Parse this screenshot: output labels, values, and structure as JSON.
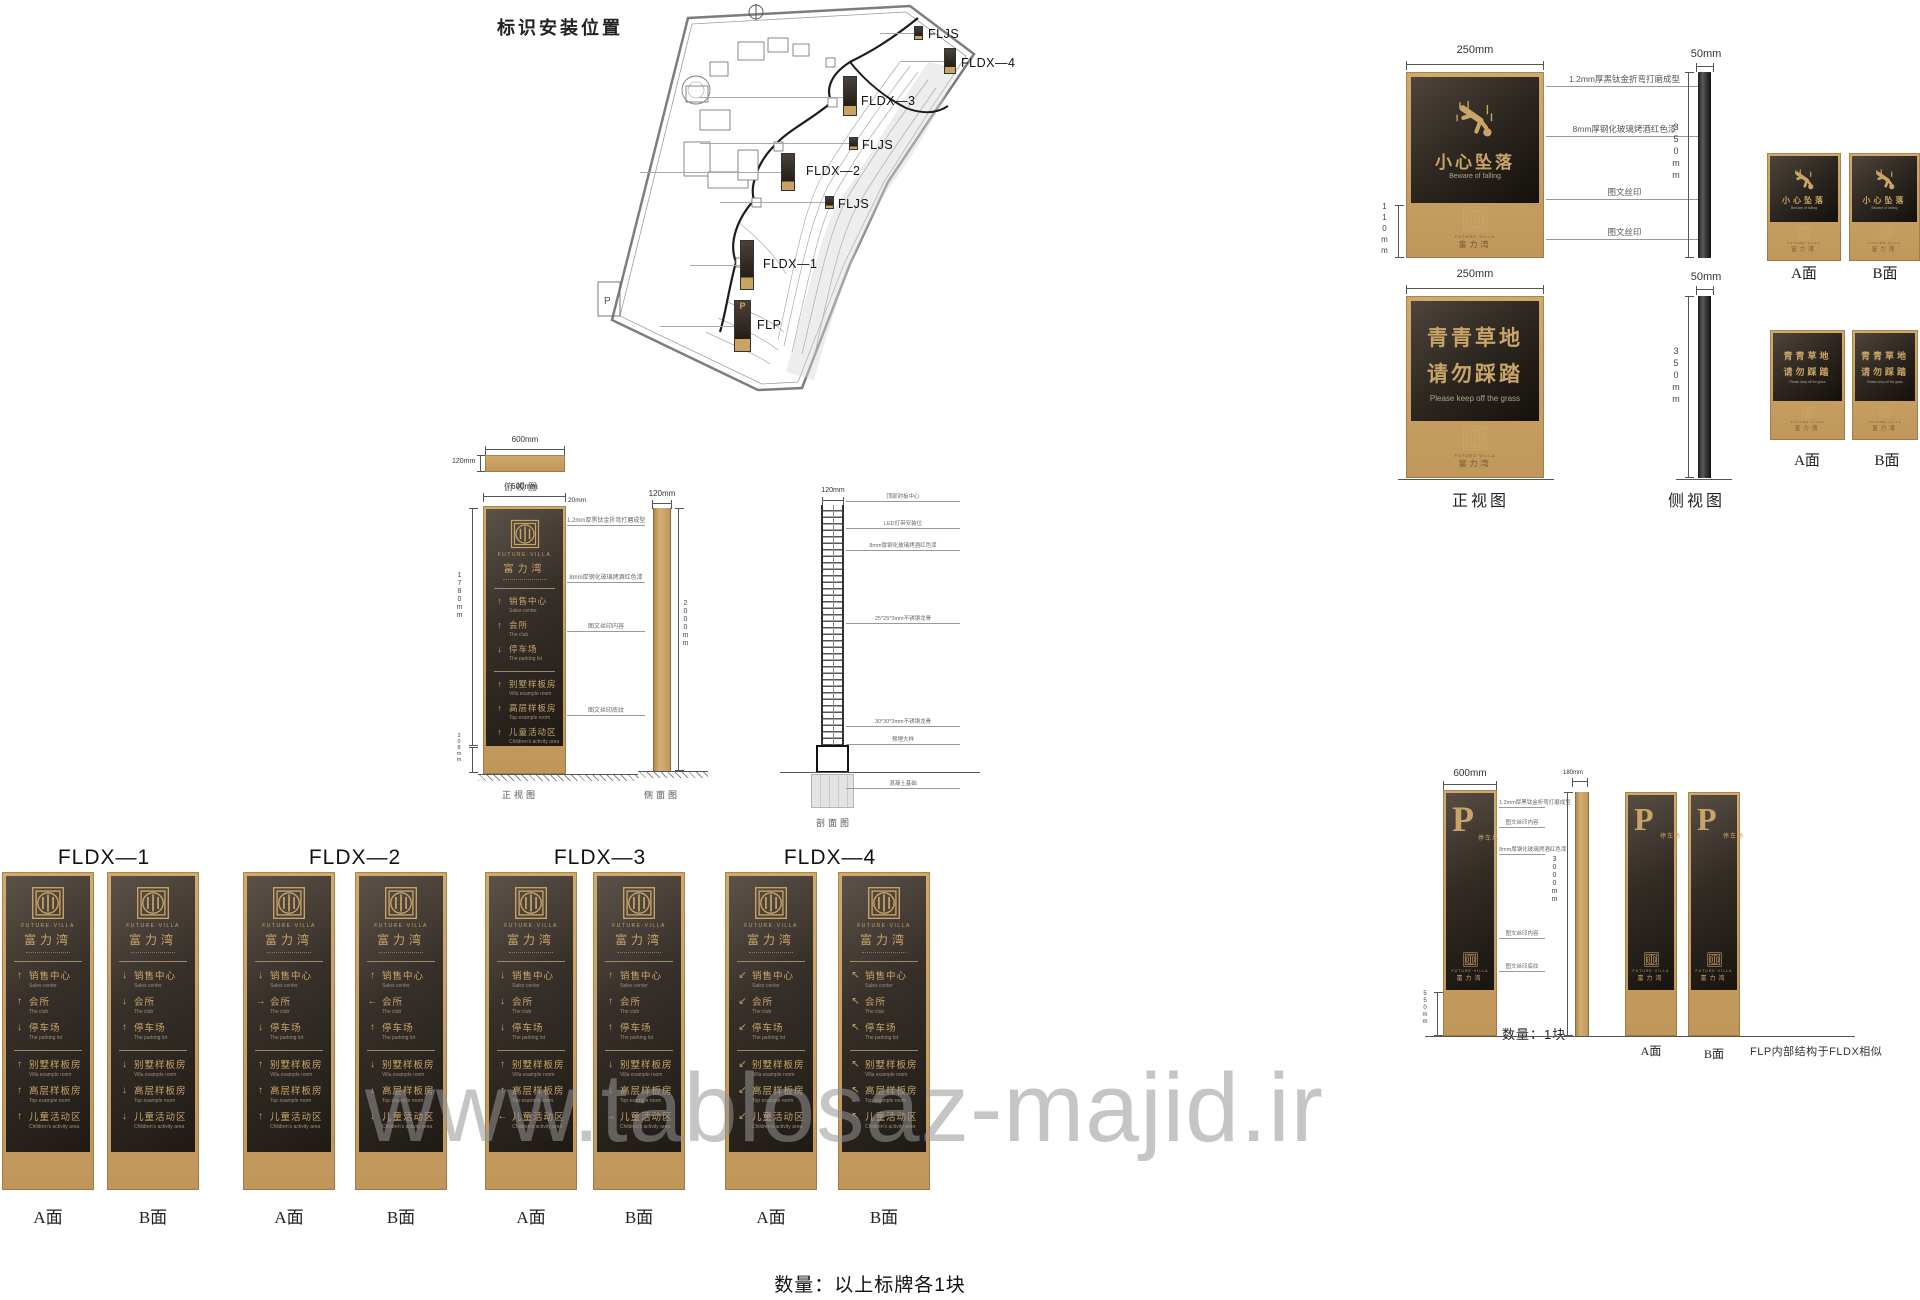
{
  "page": {
    "watermark": "www.tablosaz-majid.ir",
    "bottom_note": "数量：以上标牌各1块"
  },
  "colors": {
    "tan": "#c9a264",
    "panel_dark": "#2b2520",
    "gold": "#c9a468",
    "entry_en_gray": "#9a8e7d"
  },
  "brand": {
    "logo_en": "FUTURE·VILLA",
    "logo_cn": "富力湾"
  },
  "map": {
    "title": "标识安装位置",
    "markers": [
      "FLJS",
      "FLDX—4",
      "FLDX—3",
      "FLJS",
      "FLDX—2",
      "FLJS",
      "FLDX—1",
      "FLP"
    ]
  },
  "warning_detail": {
    "dim_width": "250mm",
    "dim_thickness": "50mm",
    "dim_height": "350mm",
    "dim_base": "110mm",
    "annotations": [
      "1.2mm厚黑钛金折弯打磨成型",
      "8mm厚钢化玻璃烤酒红色漆",
      "图文丝印",
      "图文丝印"
    ],
    "front_view_label": "正视图",
    "side_view_label": "侧视图",
    "face_a": "A面",
    "face_b": "B面",
    "sign1": {
      "cn": "小心坠落",
      "en": "Beware of falling"
    },
    "sign2": {
      "cn1": "青青草地",
      "cn2": "请勿踩踏",
      "en": "Please keep off the grass"
    }
  },
  "directory": {
    "group1": [
      {
        "cn": "销售中心",
        "en": "Sales center"
      },
      {
        "cn": "会所",
        "en": "The club"
      },
      {
        "cn": "停车场",
        "en": "The parking lot"
      }
    ],
    "group2": [
      {
        "cn": "别墅样板房",
        "en": "Villa example room"
      },
      {
        "cn": "高层样板房",
        "en": "Top example room"
      },
      {
        "cn": "儿童活动区",
        "en": "Children's activity area"
      }
    ]
  },
  "elevation": {
    "plan": {
      "dim_w": "600mm",
      "dim_h": "120mm",
      "label": "俯视图"
    },
    "front": {
      "dim_w": "600mm",
      "dim_edge": "20mm",
      "dim_body": "1780mm",
      "dim_base": "208mm",
      "label": "正视图",
      "annotations": [
        "1.2mm厚黑钛金折弯打磨成型",
        "8mm厚钢化玻璃烤酒红色漆",
        "图文丝印内容",
        "图文丝印底纹"
      ]
    },
    "side": {
      "dim_w": "120mm",
      "dim_h": "2000mm",
      "label": "侧面图"
    },
    "section": {
      "dim_w": "120mm",
      "label": "剖面图",
      "annotations": [
        "顶部封板中心",
        "LED灯带安装位",
        "8mm厚钢化玻璃烤酒红色漆",
        "25*25*3mm不锈钢龙骨",
        "30*30*3mm不锈钢龙骨",
        "预埋大样",
        "混凝土基础"
      ]
    }
  },
  "fldx": {
    "face_a": "A面",
    "face_b": "B面",
    "variants": [
      {
        "title": "FLDX—1",
        "a": [
          "↑",
          "↑",
          "↓",
          "↑",
          "↑",
          "↑"
        ],
        "b": [
          "↓",
          "↓",
          "↑",
          "↓",
          "↓",
          "↓"
        ]
      },
      {
        "title": "FLDX—2",
        "a": [
          "↓",
          "→",
          "↓",
          "↑",
          "↑",
          "↑"
        ],
        "b": [
          "↑",
          "←",
          "↑",
          "↓",
          "↓",
          "↓"
        ]
      },
      {
        "title": "FLDX—3",
        "a": [
          "↓",
          "↓",
          "↓",
          "↑",
          "↑",
          "←"
        ],
        "b": [
          "↑",
          "↑",
          "↑",
          "↓",
          "↓",
          "→"
        ]
      },
      {
        "title": "FLDX—4",
        "a": [
          "↙",
          "↙",
          "↙",
          "↙",
          "↙",
          "↙"
        ],
        "b": [
          "↖",
          "↖",
          "↖",
          "↖",
          "↖",
          "↖"
        ]
      }
    ]
  },
  "flp": {
    "letter": "P",
    "cn": "停车场",
    "dim_w": "600mm",
    "dim_base": "550mm",
    "dim_side_w": "180mm",
    "dim_h": "3000mm",
    "qty": "数量：1块",
    "note": "FLP内部结构于FLDX相似",
    "face_a": "A面",
    "face_b": "B面",
    "annotations": [
      "1.2mm厚黑钛金折弯打磨成型",
      "图文丝印内容",
      "8mm厚钢化玻璃烤酒红色漆",
      "图文丝印内容",
      "图文丝印底纹"
    ]
  }
}
